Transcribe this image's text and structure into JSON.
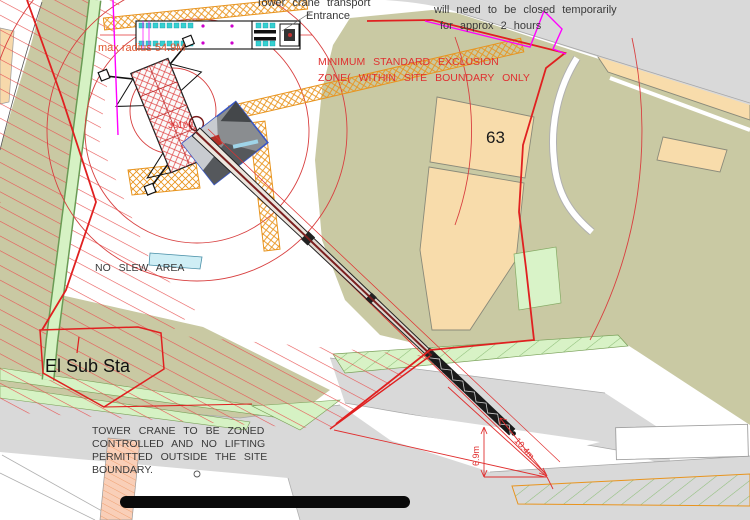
{
  "annotations": {
    "entrance_note_line1": "Tower crane transport",
    "entrance_note_line2": "Entrance",
    "closure_note_line1": "will need to be closed temporarily",
    "closure_note_line2": "for approx 2 hours",
    "exclusion_line1": "MINIMUM STANDARD EXCLUSION",
    "exclusion_line2": "ZONE( WITHIN SITE BOUNDARY ONLY",
    "radius_label": "max radius 54.9M",
    "dim_small": "30100",
    "building_number": "63",
    "no_slew": "NO SLEW AREA",
    "substation": "El Sub Sta",
    "zone_note_line1": "TOWER CRANE TO BE ZONED",
    "zone_note_line2": "CONTROLLED AND NO LIFTING",
    "zone_note_line3": "PERMITTED OUTSIDE THE SITE",
    "zone_note_line4": "BOUNDARY.",
    "dim_boom": "10.4m",
    "dim_offset": "6.9m"
  },
  "colors": {
    "site_boundary_red": "#e02020",
    "boundary_magenta": "#ff00ff",
    "exclusion_circle_red": "#d84040",
    "hatch_red": "#e85555",
    "building_peach": "#f8dcab",
    "ground_olive": "#c9c9a3",
    "verge_green": "#d6f2c4",
    "road_gray": "#d9d9d9",
    "lattice_orange": "#e8941e",
    "photo_border_blue": "#3a57c4"
  }
}
